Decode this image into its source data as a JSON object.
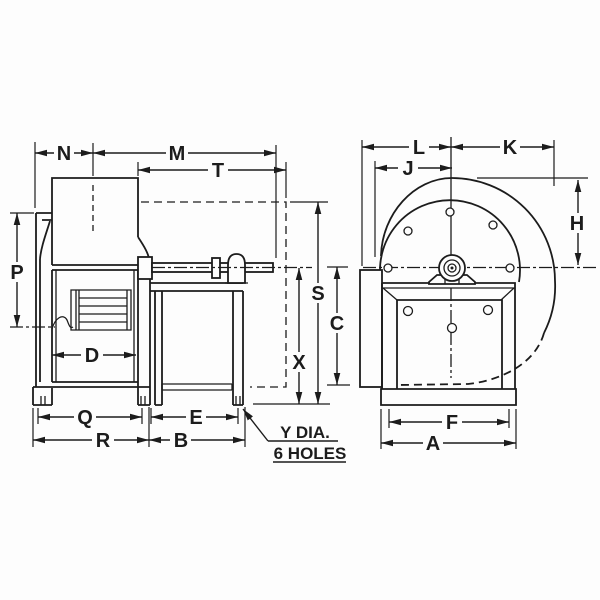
{
  "diagram": {
    "background_color": "#fdfdfd",
    "line_color": "#1c1c1c",
    "dims": {
      "n": "N",
      "m": "M",
      "t": "T",
      "p": "P",
      "d": "D",
      "q": "Q",
      "r": "R",
      "e": "E",
      "b": "B",
      "s": "S",
      "x": "X",
      "c": "C",
      "l": "L",
      "k": "K",
      "j": "J",
      "h": "H",
      "f": "F",
      "a": "A"
    },
    "callout": {
      "line1": "Y DIA.",
      "line2": "6 HOLES"
    }
  }
}
